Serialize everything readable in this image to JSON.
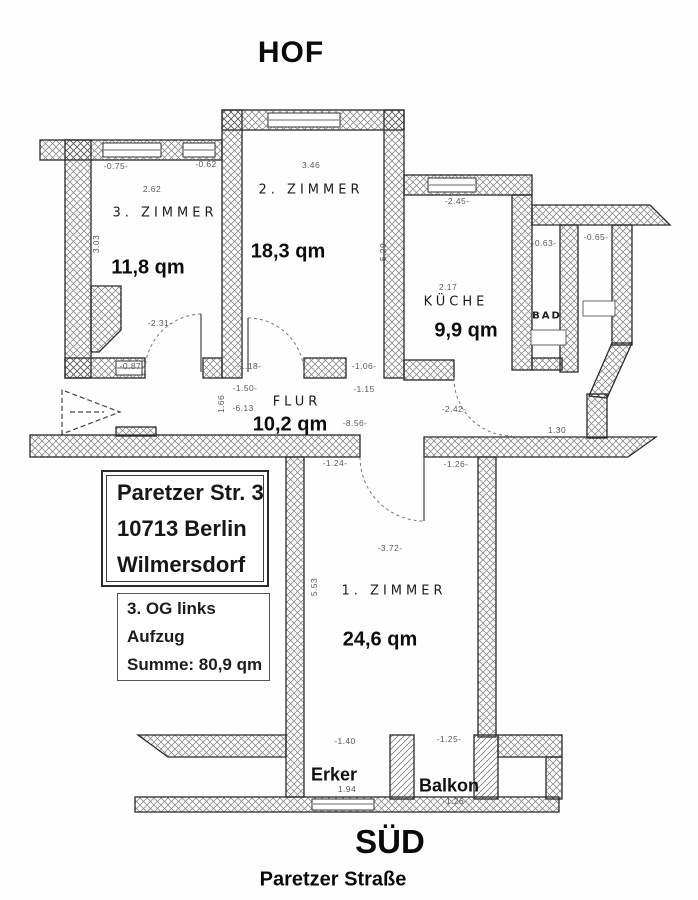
{
  "titles": {
    "top": "HOF",
    "bottom": "SÜD",
    "street": "Paretzer Straße"
  },
  "address_box": {
    "line1": "Paretzer Str. 3",
    "line2": "10713 Berlin",
    "line3": "Wilmersdorf"
  },
  "info_box": {
    "line1": "3. OG links",
    "line2": "Aufzug",
    "line3": "Summe: 80,9 qm"
  },
  "rooms": [
    {
      "name": "1. Zimmer",
      "area": "24,6 qm"
    },
    {
      "name": "2. Zimmer",
      "area": "18,3 qm"
    },
    {
      "name": "3. Zimmer",
      "area": "11,8 qm"
    },
    {
      "name": "Küche",
      "area": "9,9 qm"
    },
    {
      "name": "Bad",
      "area": ""
    },
    {
      "name": "Flur",
      "area": "10,2 qm"
    },
    {
      "name": "Erker",
      "area": ""
    },
    {
      "name": "Balkon",
      "area": ""
    }
  ],
  "plan_labels": [
    {
      "text": "3. ZIMMER",
      "x": 165,
      "y": 213,
      "cls": "room"
    },
    {
      "text": "2. ZIMMER",
      "x": 311,
      "y": 190,
      "cls": "room"
    },
    {
      "text": "KÜCHE",
      "x": 456,
      "y": 302,
      "cls": "room"
    },
    {
      "text": "BAD",
      "x": 547,
      "y": 316,
      "cls": "room-sm"
    },
    {
      "text": "FLUR",
      "x": 297,
      "y": 402,
      "cls": "room"
    },
    {
      "text": "1. ZIMMER",
      "x": 394,
      "y": 591,
      "cls": "room"
    },
    {
      "text": "11,8 qm",
      "x": 148,
      "y": 268,
      "cls": "area"
    },
    {
      "text": "18,3 qm",
      "x": 288,
      "y": 252,
      "cls": "area"
    },
    {
      "text": "9,9 qm",
      "x": 466,
      "y": 331,
      "cls": "area"
    },
    {
      "text": "10,2 qm",
      "x": 290,
      "y": 425,
      "cls": "area"
    },
    {
      "text": "24,6 qm",
      "x": 380,
      "y": 640,
      "cls": "area"
    },
    {
      "text": "Erker",
      "x": 334,
      "y": 775,
      "cls": "overlay"
    },
    {
      "text": "Balkon",
      "x": 449,
      "y": 786,
      "cls": "overlay"
    },
    {
      "text": "-0.75-",
      "x": 116,
      "y": 166,
      "cls": "dim"
    },
    {
      "text": "-0.62",
      "x": 206,
      "y": 164,
      "cls": "dim"
    },
    {
      "text": "2.62",
      "x": 152,
      "y": 189,
      "cls": "dim"
    },
    {
      "text": "3.03",
      "x": 96,
      "y": 244,
      "cls": "dim-v"
    },
    {
      "text": "-2.31-",
      "x": 160,
      "y": 323,
      "cls": "dim"
    },
    {
      "text": "-0.87-",
      "x": 132,
      "y": 366,
      "cls": "dim"
    },
    {
      "text": "3.46",
      "x": 311,
      "y": 165,
      "cls": "dim"
    },
    {
      "text": "5.29",
      "x": 383,
      "y": 252,
      "cls": "dim-v"
    },
    {
      "text": "-1.18-",
      "x": 249,
      "y": 366,
      "cls": "dim"
    },
    {
      "text": "-1.50-",
      "x": 245,
      "y": 388,
      "cls": "dim"
    },
    {
      "text": "-6.13",
      "x": 243,
      "y": 408,
      "cls": "dim"
    },
    {
      "text": "1.66",
      "x": 221,
      "y": 404,
      "cls": "dim-v"
    },
    {
      "text": "-1.06-",
      "x": 364,
      "y": 366,
      "cls": "dim"
    },
    {
      "text": "-1.15",
      "x": 364,
      "y": 389,
      "cls": "dim"
    },
    {
      "text": "-8.56-",
      "x": 355,
      "y": 423,
      "cls": "dim"
    },
    {
      "text": "-2.45-",
      "x": 457,
      "y": 201,
      "cls": "dim"
    },
    {
      "text": "2.17",
      "x": 448,
      "y": 287,
      "cls": "dim"
    },
    {
      "text": "-0.63-",
      "x": 544,
      "y": 243,
      "cls": "dim"
    },
    {
      "text": "-0.65-",
      "x": 596,
      "y": 237,
      "cls": "dim"
    },
    {
      "text": "-2.42-",
      "x": 454,
      "y": 409,
      "cls": "dim"
    },
    {
      "text": "1.30",
      "x": 557,
      "y": 430,
      "cls": "dim"
    },
    {
      "text": "-1.26-",
      "x": 456,
      "y": 464,
      "cls": "dim"
    },
    {
      "text": "-1.24-",
      "x": 335,
      "y": 463,
      "cls": "dim"
    },
    {
      "text": "-3.72-",
      "x": 390,
      "y": 548,
      "cls": "dim"
    },
    {
      "text": "5.53",
      "x": 314,
      "y": 587,
      "cls": "dim-v"
    },
    {
      "text": "-1.40",
      "x": 345,
      "y": 741,
      "cls": "dim"
    },
    {
      "text": "-1.25-",
      "x": 449,
      "y": 739,
      "cls": "dim"
    },
    {
      "text": "1.94",
      "x": 347,
      "y": 789,
      "cls": "dim"
    },
    {
      "text": "-1.26-",
      "x": 455,
      "y": 801,
      "cls": "dim"
    }
  ]
}
